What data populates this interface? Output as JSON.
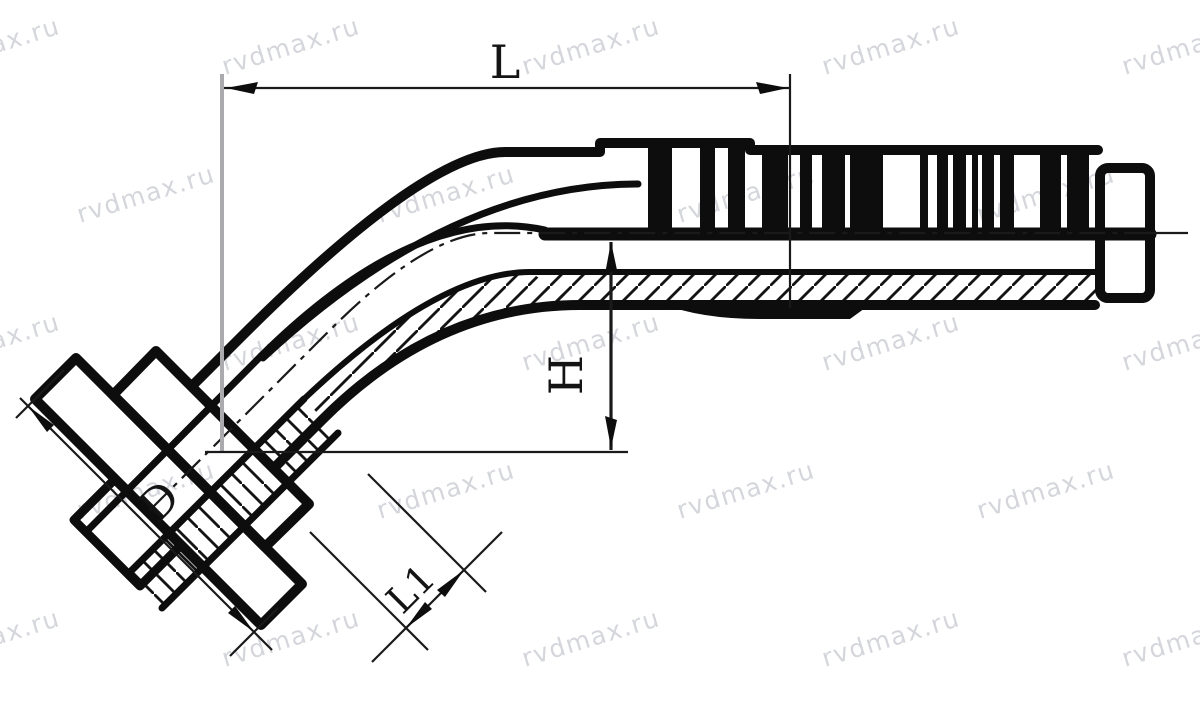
{
  "drawing": {
    "kind": "45-degree flange hose fitting - dimensional line drawing",
    "watermark": {
      "text": "rvdmax.ru",
      "color": "#9aa0ae",
      "opacity": 0.42,
      "font_size": 25,
      "angle_deg": -17
    },
    "colors": {
      "line": "#0d0d0d",
      "background": "#ffffff",
      "extension_line_gray": "#ababaf"
    },
    "dims": {
      "L": {
        "label": "L"
      },
      "H": {
        "label": "H"
      },
      "D": {
        "label": "D"
      },
      "L1": {
        "label": "L1"
      }
    }
  }
}
